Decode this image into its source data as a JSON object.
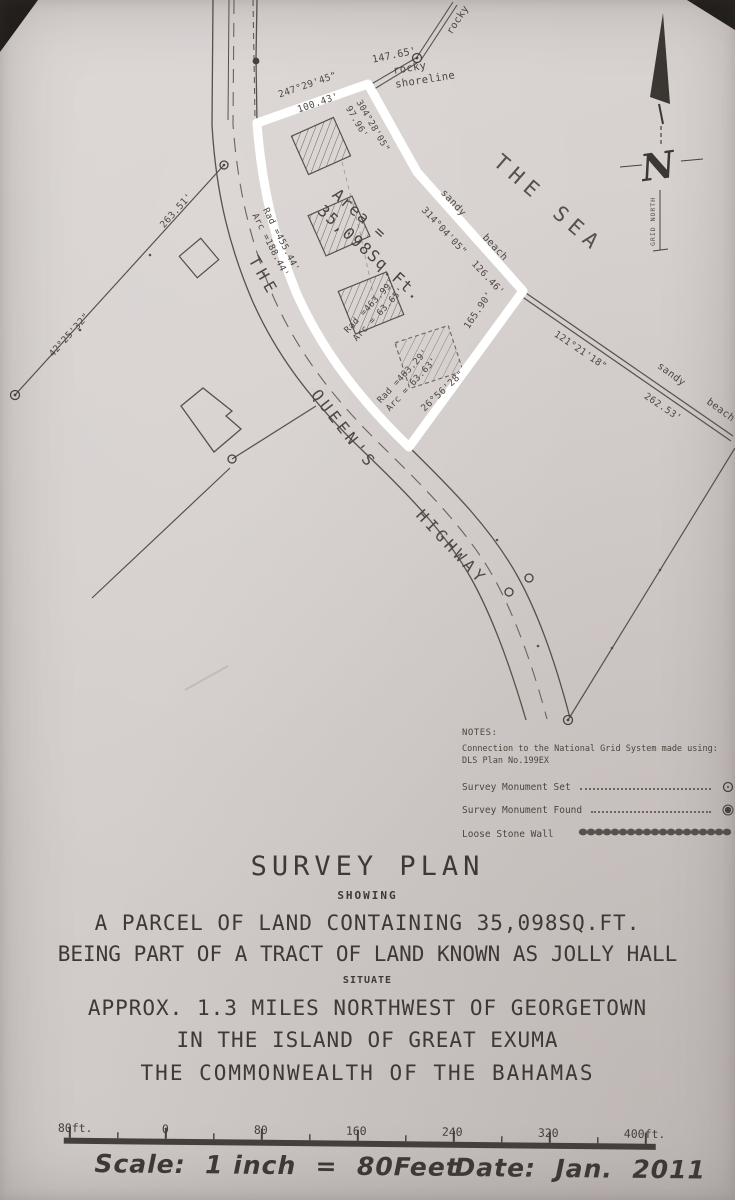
{
  "map": {
    "sea": "THE SEA",
    "road_the": "THE",
    "road_queens": "QUEEN'S",
    "road_highway": "HIGHWAY",
    "rocky_upper": "rocky",
    "rocky_shoreline": "rocky\nshoreline",
    "shore_len": "147.65'",
    "area": "Area =\n35,098Sq.Ft.",
    "bearing_top": "247°29'45\"",
    "bearing_top_len": "100.43'",
    "bearing_ne": "304°28'05\"\n97.96'",
    "bearing_sea": "314°04'05\"  126.46'",
    "sandy_beach_1": "sandy  beach",
    "len_east": "165.90'",
    "bearing_bottom": "26°56'28\"",
    "bearing_beach": "121°21'18\"",
    "len_beach": "262.53'",
    "sandy_beach_2": "sandy  beach",
    "bearing_west": "42°25'32\"",
    "len_west": "263.51'",
    "curve1": "Rad =455.44'\nArc =188.44'",
    "curve2": "Rad =463.99'\nArc = 63.65'",
    "curve3": "Rad =463.29'\nArc = 63.63'",
    "north_letter": "N",
    "north_caption": "GRID NORTH"
  },
  "notes": {
    "heading": "NOTES:",
    "line1": "Connection to the National Grid System made using:",
    "line2": "DLS Plan No.199EX",
    "legend": [
      {
        "label": "Survey Monument Set",
        "symbol": "open-circle"
      },
      {
        "label": "Survey Monument Found",
        "symbol": "filled-circle"
      },
      {
        "label": "Loose Stone Wall",
        "symbol": "stone-wall-chain"
      }
    ]
  },
  "title_block": {
    "title": "SURVEY PLAN",
    "showing": "SHOWING",
    "line1": "A PARCEL OF LAND CONTAINING 35,098SQ.FT.",
    "line2": "BEING PART OF A TRACT OF LAND KNOWN AS JOLLY HALL",
    "situate": "SITUATE",
    "line3": "APPROX. 1.3 MILES NORTHWEST OF GEORGETOWN",
    "line4": "IN THE ISLAND OF GREAT EXUMA",
    "line5": "THE COMMONWEALTH OF THE BAHAMAS"
  },
  "scale_bar": {
    "labels": [
      "80ft.",
      "0",
      "80",
      "160",
      "240",
      "320",
      "400ft."
    ],
    "scale_text": "Scale:  1 inch  =  80Feet",
    "date_text": "Date:  Jan.  2011"
  },
  "colors": {
    "ink": "#4e4843",
    "highlight": "#ffffff",
    "paper": "#d5cfcd"
  }
}
